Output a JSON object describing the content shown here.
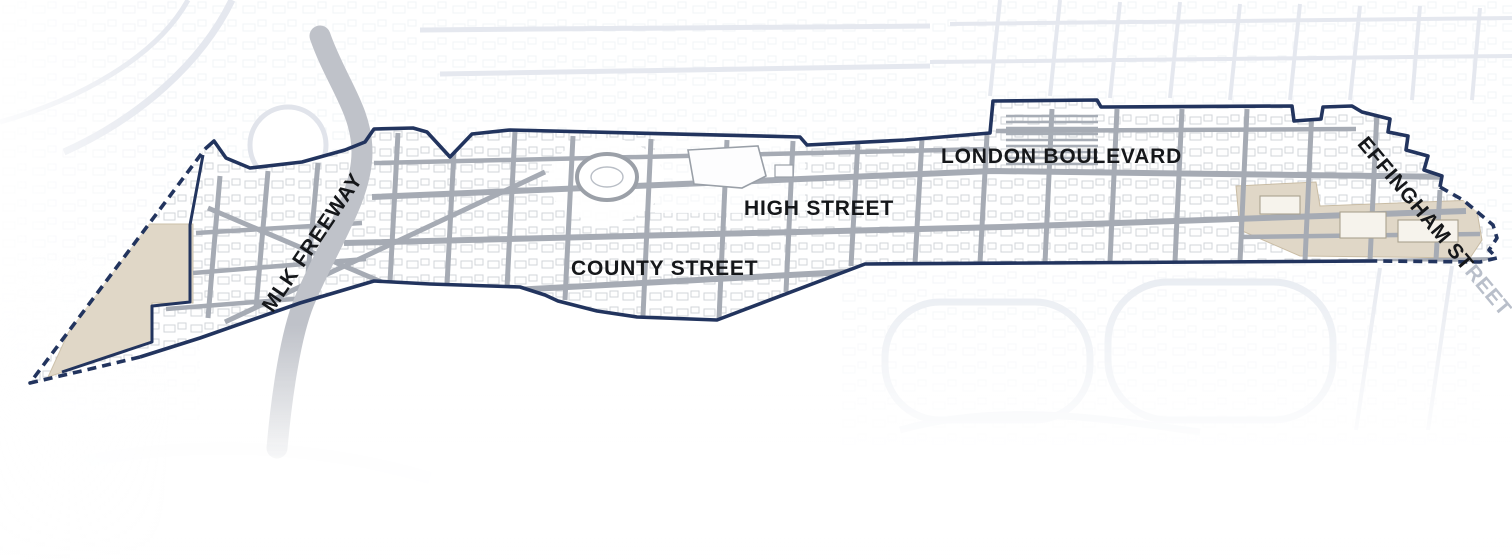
{
  "map": {
    "labels": {
      "mlk_freeway": "MLK FREEWAY",
      "county_street": "COUNTY STREET",
      "high_street": "HIGH STREET",
      "london_boulevard": "LONDON BOULEVARD",
      "effingham_street_inside": "EFFINGHAM ST",
      "effingham_street_outside": "REET"
    },
    "colors": {
      "boundary_navy": "#22345e",
      "street_gray": "#a6abb4",
      "freeway_gray": "#bfc2c9",
      "parcel_tan": "#e0d7c7",
      "faded_map_gray": "#d0d6e2",
      "label_black": "#15171a",
      "label_faded_gray": "#b9bfca",
      "background_white": "#ffffff"
    }
  }
}
